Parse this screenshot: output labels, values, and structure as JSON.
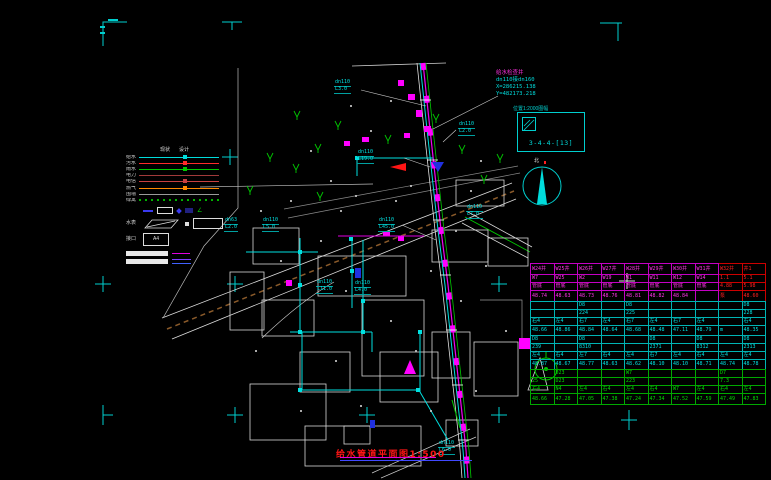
{
  "callout": {
    "title": "给水检查井",
    "spec": "dn110接dn160",
    "x_coord": "X=286215.138",
    "y_coord": "Y=482173.218"
  },
  "index_box": {
    "caption": "位置1:2000图幅",
    "code": "3-4-4-[13]"
  },
  "north_arrow": {
    "label": "北"
  },
  "drawing_title": {
    "text": "给水管道平面图1:500"
  },
  "legend": {
    "col_headers": [
      "现状",
      "设计"
    ],
    "rows": [
      {
        "label": "给水",
        "color": "#00dcdc"
      },
      {
        "label": "污水",
        "color": "#ff2a2a"
      },
      {
        "label": "雨水",
        "color": "#00c800"
      },
      {
        "label": "电力",
        "color": "#a03a3a"
      },
      {
        "label": "电信",
        "color": "#c84040"
      },
      {
        "label": "燃气",
        "color": "#ff8a00"
      },
      {
        "label": "围墙",
        "color": "#9a9a9a"
      },
      {
        "label": "绿篱",
        "color": "#00b400",
        "dashed": true
      }
    ],
    "meter_row_label": "水表",
    "joint_row_label": "接口",
    "joint_code": "A4"
  },
  "map_labels": [
    {
      "size": "dn110",
      "len": "L3.0",
      "x": 334,
      "y": 80
    },
    {
      "size": "dn110",
      "len": "L2.0",
      "x": 458,
      "y": 122
    },
    {
      "size": "dn110",
      "len": "L19.0",
      "x": 357,
      "y": 150
    },
    {
      "size": "dn110",
      "len": "L7.0",
      "x": 466,
      "y": 205
    },
    {
      "size": "dn63",
      "len": "L2.0",
      "x": 224,
      "y": 218
    },
    {
      "size": "dn110",
      "len": "L5.0",
      "x": 262,
      "y": 218
    },
    {
      "size": "dn110",
      "len": "L45.0",
      "x": 378,
      "y": 218
    },
    {
      "size": "dn110",
      "len": "L11.0",
      "x": 316,
      "y": 280
    },
    {
      "size": "dn110",
      "len": "L4.0",
      "x": 354,
      "y": 281
    },
    {
      "size": "dn110",
      "len": "L6.0",
      "x": 438,
      "y": 441
    }
  ],
  "table": {
    "sections": [
      {
        "border": "#c400c4",
        "text": "#ff35e6",
        "red_from": 8,
        "red_text": "#ff2020",
        "red_border": "#cc0000",
        "row_h": [
          11,
          8,
          8,
          11
        ],
        "rows": [
          [
            "W24井",
            "W25井",
            "W26井",
            "W27井",
            "W28井",
            "W29井",
            "W30井",
            "W31井",
            "W32井",
            "井1"
          ],
          [
            "W7",
            "W25",
            "W2",
            "W19",
            "W1",
            "W11",
            "W12",
            "W14",
            "1.1",
            "5.1"
          ],
          [
            "管底",
            "管底",
            "管底",
            "管底",
            "管底",
            "管底",
            "管底",
            "管底",
            "4.88",
            "5.98"
          ],
          [
            "48.74",
            "48.63",
            "48.73",
            "48.76",
            "48.81",
            "48.82",
            "48.84",
            "",
            "泵",
            "48.60"
          ]
        ]
      },
      {
        "border": "#00b4b4",
        "text": "#00e0e0",
        "row_h": [
          8,
          8,
          8,
          10
        ],
        "rows": [
          [
            "",
            "",
            "D8",
            "",
            "D8",
            "",
            "",
            "",
            "",
            "D8"
          ],
          [
            "",
            "",
            "224",
            "",
            "225",
            "",
            "",
            "",
            "",
            "228"
          ],
          [
            "右4",
            "左4",
            "右7",
            "左4",
            "右7",
            "左4",
            "右7",
            "左4",
            "",
            "右4"
          ],
          [
            "48.66",
            "48.86",
            "48.84",
            "48.64",
            "48.68",
            "48.48",
            "47.11",
            "48.79",
            "m",
            "48.35"
          ]
        ]
      },
      {
        "border": "#00b4b4",
        "text": "#00e0e0",
        "row_h": [
          8,
          8,
          8,
          10
        ],
        "rows": [
          [
            "D8",
            "",
            "D8",
            "",
            "",
            "D8",
            "",
            "D8",
            "",
            "D8"
          ],
          [
            "239",
            "",
            "8310",
            "",
            "",
            "2371",
            "",
            "8312",
            "",
            "2313"
          ],
          [
            "左4",
            "右4",
            "左7",
            "右4",
            "左4",
            "右7",
            "左4",
            "右4",
            "左4",
            "左4"
          ],
          [
            "48.87",
            "48.67",
            "48.77",
            "48.63",
            "48.62",
            "48.10",
            "48.10",
            "48.71",
            "48.74",
            "48.78"
          ]
        ]
      },
      {
        "border": "#00a800",
        "text": "#00dc00",
        "row_h": [
          8,
          8,
          8,
          11
        ],
        "rows": [
          [
            "",
            "D23",
            "",
            "",
            "W7",
            "",
            "",
            "",
            "D7",
            ""
          ],
          [
            "25",
            "D23",
            "",
            "",
            "223",
            "",
            "",
            "",
            "7.3",
            ""
          ],
          [
            "右4",
            "N4",
            "左4",
            "右4",
            "左4",
            "右4",
            "W7",
            "左4",
            "右4",
            "左4"
          ],
          [
            "48.66",
            "47.28",
            "47.05",
            "47.38",
            "47.24",
            "47.34",
            "47.52",
            "47.59",
            "47.49",
            "47.83"
          ]
        ]
      }
    ]
  }
}
